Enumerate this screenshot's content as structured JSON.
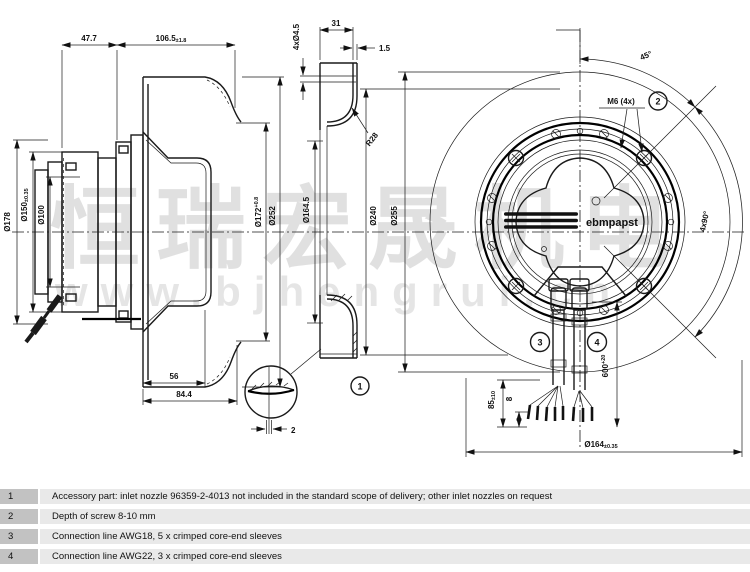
{
  "watermark": {
    "cn": "恒瑞宏晟机电",
    "url": "www.bjhengrui.cn"
  },
  "logo": "ebmpapst",
  "dims": {
    "d47_7": "47.7",
    "d106_5": "106.5",
    "d106_5_tol": "±1.8",
    "d4xd4_5": "4xØ4.5",
    "d31": "31",
    "d1_5": "1.5",
    "r28": "R28",
    "d178": "Ø178",
    "d150": "Ø150",
    "d150_tol": "±0.35",
    "d100": "Ø100",
    "d172": "Ø172",
    "d172_tol": "+0.8",
    "d252": "Ø252",
    "d164_5": "Ø164.5",
    "d240": "Ø240",
    "d255": "Ø255",
    "d56": "56",
    "d84_4": "84.4",
    "d2": "2",
    "deg45": "45°",
    "m6": "M6 (4x)",
    "deg4x90": "4x90°",
    "d85": "85",
    "d85_tol": "±10",
    "d8": "8",
    "d600": "600",
    "d600_tol": "+20",
    "d164": "Ø164",
    "d164_tol": "±0.35"
  },
  "callouts": {
    "c1": "1",
    "c2": "2",
    "c3": "3",
    "c4": "4"
  },
  "notes": [
    {
      "num": "1",
      "text": "Accessory part: inlet nozzle 96359-2-4013 not included in the standard scope of delivery; other inlet nozzles on request"
    },
    {
      "num": "2",
      "text": "Depth of screw 8-10 mm"
    },
    {
      "num": "3",
      "text": "Connection line AWG18, 5 x crimped core-end sleeves"
    },
    {
      "num": "4",
      "text": "Connection line AWG22, 3 x crimped core-end sleeves"
    }
  ]
}
